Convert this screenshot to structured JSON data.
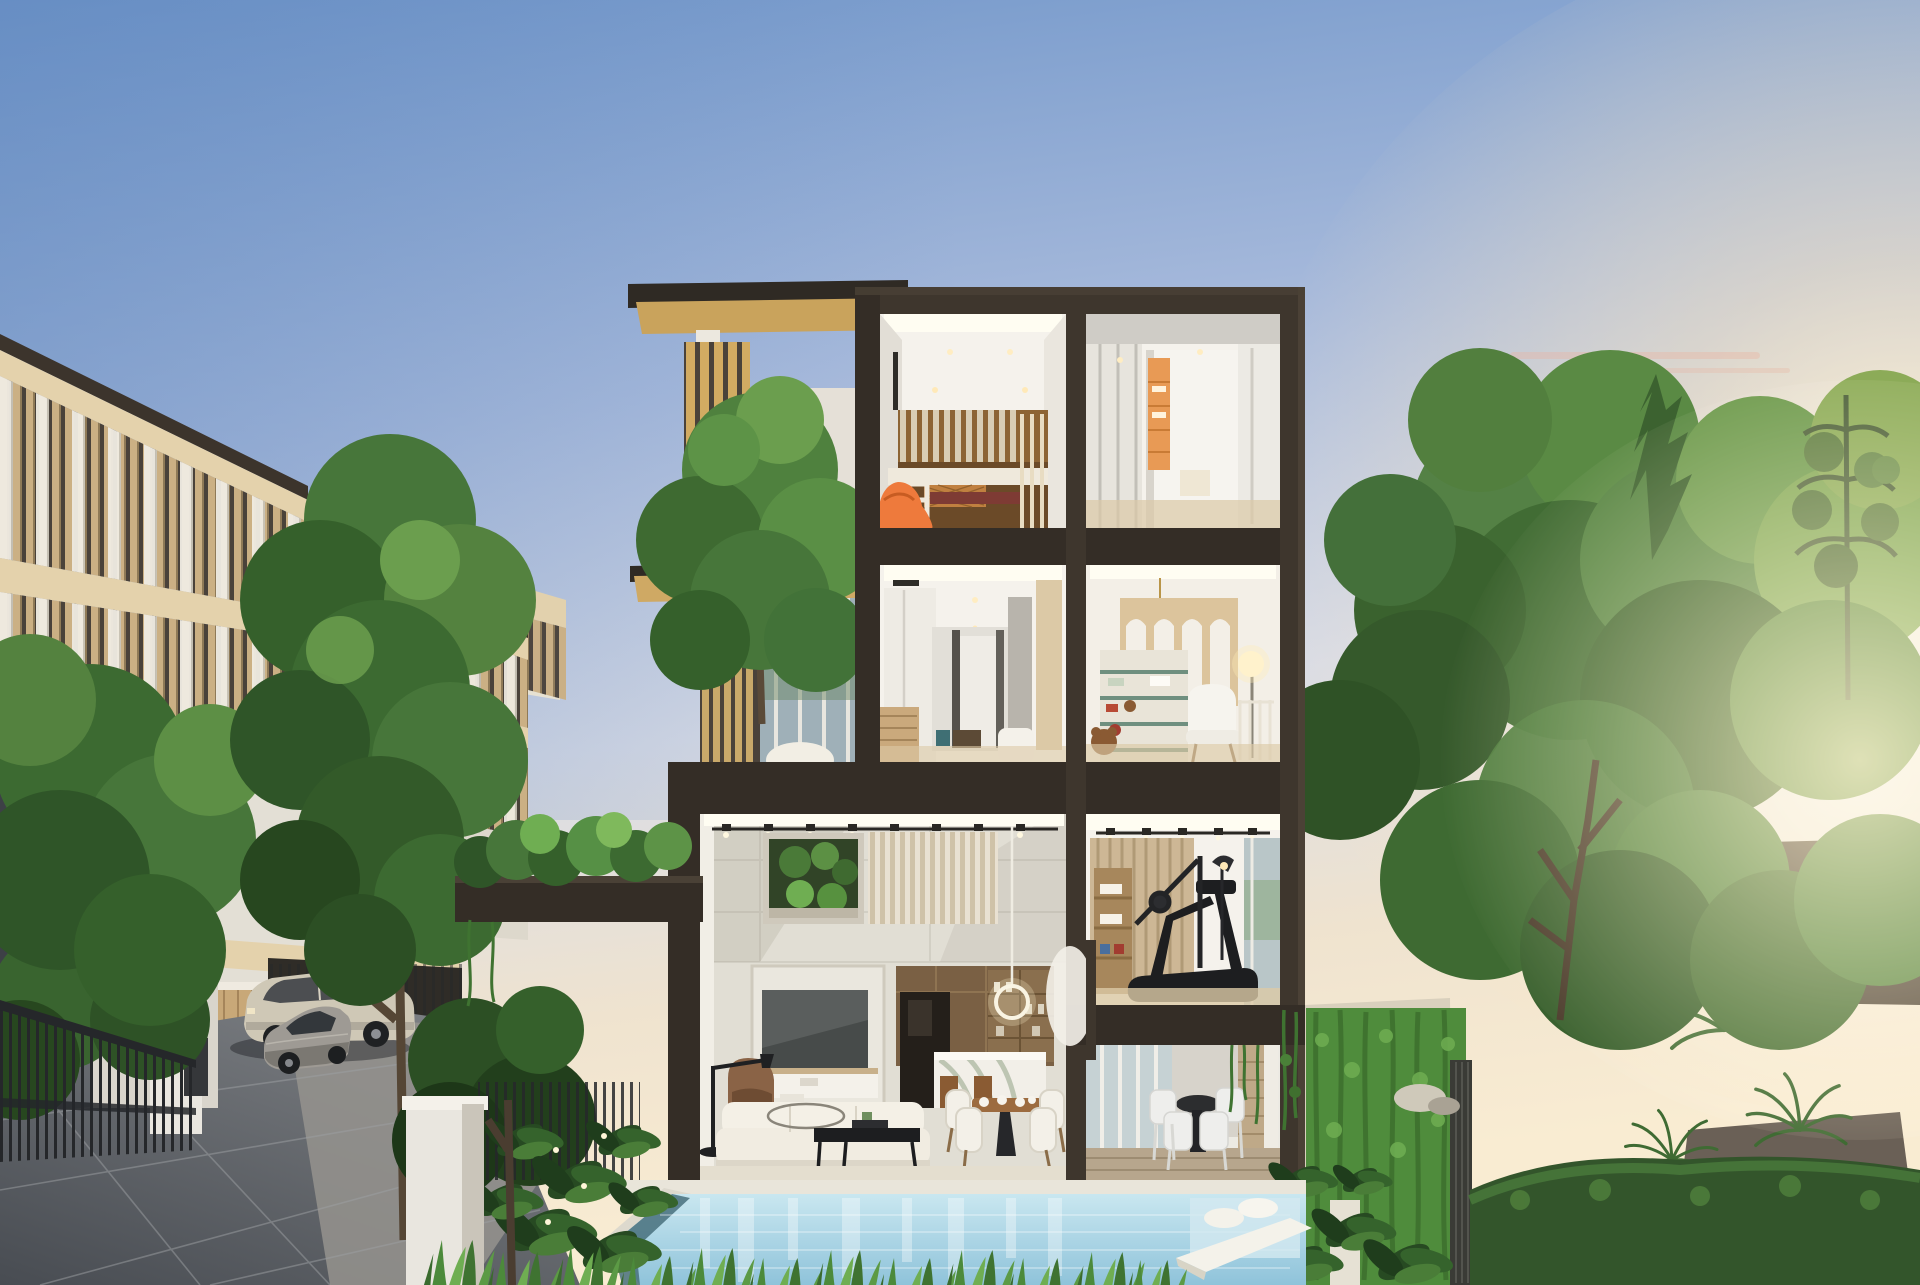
{
  "meta": {
    "description": "Dusk architectural rendering of a modern four-storey luxury villa shown as a cutaway dollhouse section with lit interior rooms (kids bunk room, dressing room, bedroom corridor, playroom, double-height living-dining room, gym, pool terrace), a front swimming pool with loungers, a louvered townhouse row with driveway and parked cars on the left, and dense sunlit garden trees on the right",
    "time_of_day": "sunset",
    "style": "photoreal CG exterior"
  },
  "palette": {
    "sky_top": "#6f95c9",
    "sky_mid": "#a9bbdc",
    "sky_pale": "#d9dce6",
    "sky_warm": "#efe3cf",
    "sky_horizon": "#f9ecd2",
    "sun_core": "#fff6dd",
    "sun_glow": "#ffe7bd",
    "cloud_pink": "#e9b4a0",
    "frame_dark": "#342d26",
    "frame_mid": "#3e362d",
    "frame_lit": "#4b4136",
    "interior_white": "#f5f2ec",
    "ceiling_cove": "#fffdf2",
    "stone_wall": "#e1ded4",
    "stone_shadow": "#c7c3b8",
    "slat_wood": "#d6c5a4",
    "wood_cabinet": "#6b4a28",
    "wood_floor": "#dcc9a6",
    "media_brown": "#7a6044",
    "tv_screen": "#474b4a",
    "sofa_white": "#f1ece1",
    "armchair_brown": "#8a6346",
    "accent_orange": "#ee7a3c",
    "bedding_maroon": "#7e3b34",
    "arch_wood": "#dcc49c",
    "louver_tan": "#cbb084",
    "louver_gap": "#4a423a",
    "slab_cream": "#e4d2ac",
    "column_white": "#f0ece3",
    "window_dark": "#3d4046",
    "glass_blue": "#aebfc6",
    "foliage_dark": "#2f5528",
    "foliage_mid": "#47763a",
    "foliage_light": "#6b9e4e",
    "foliage_sunlit": "#9db95f",
    "trunk_brown": "#5f503d",
    "hedge_dark": "#33552b",
    "ivy_green": "#4f8c3c",
    "grass_green": "#4c8a3b",
    "pool_light": "#c9e7f0",
    "pool_deep": "#8fc3da",
    "pool_wall": "#48707c",
    "coping_stone": "#e9e5da",
    "deck_wood": "#b7a68d",
    "road_dark": "#484c52",
    "road_light": "#95938e",
    "fence_black": "#25272a",
    "car_champagne": "#cfc8b6",
    "car_gray": "#9e9a94",
    "roof_distant": "#4d4339",
    "terrace_wall": "#d7d3cb"
  },
  "scene": {
    "objects": [
      {
        "name": "sky",
        "label": "sunset gradient sky"
      },
      {
        "name": "main-villa-cutaway",
        "label": "four storey sectioned villa with dark frame"
      },
      {
        "name": "bunk-room",
        "label": "kids room with bunk bed and orange beanbag"
      },
      {
        "name": "dressing-room",
        "label": "dressing room with lit shelving"
      },
      {
        "name": "bedroom-corridor",
        "label": "bedroom level corridor"
      },
      {
        "name": "playroom",
        "label": "nursery playroom with arched shelving"
      },
      {
        "name": "living-room",
        "label": "double height living and dining room"
      },
      {
        "name": "gym",
        "label": "home gym with treadmill"
      },
      {
        "name": "pool-terrace",
        "label": "covered terrace with outdoor dining set"
      },
      {
        "name": "swimming-pool",
        "label": "front swimming pool with floats and lounger"
      },
      {
        "name": "townhouse-row",
        "label": "louvered townhouses on the left"
      },
      {
        "name": "driveway",
        "label": "paved driveway with two parked cars"
      },
      {
        "name": "garden",
        "label": "trees, hedges and ivy walls"
      }
    ]
  }
}
